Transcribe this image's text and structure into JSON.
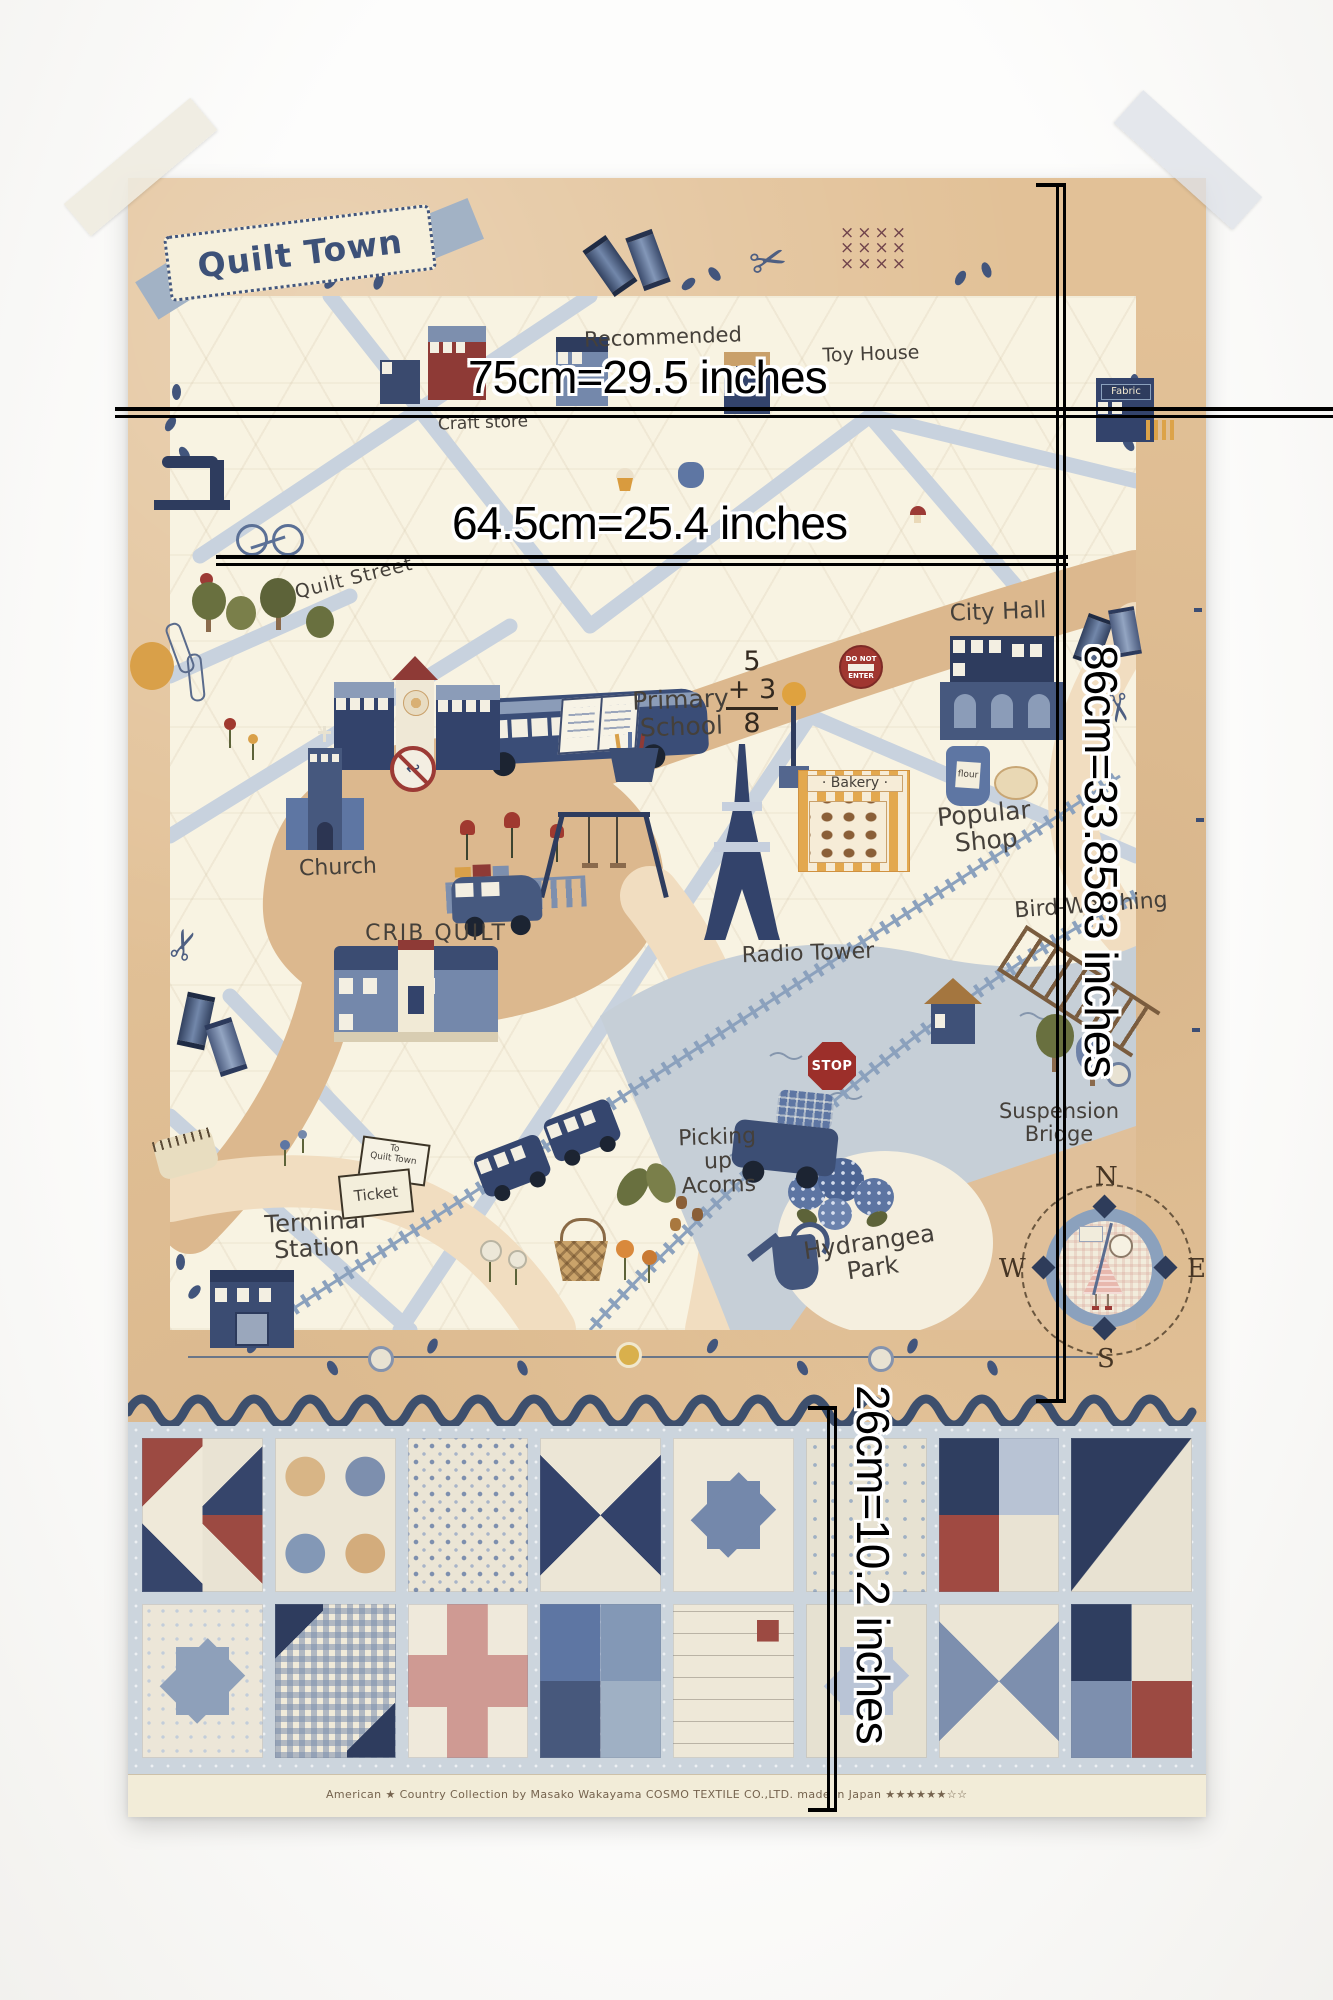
{
  "measurements": {
    "width_top": "75cm=29.5 inches",
    "width_mid": "64.5cm=25.4 inches",
    "height_map": "86cm=33.8583 inches",
    "height_quilt_strip": "26cm=10.2 inches"
  },
  "panel": {
    "banner_title": "Quilt Town",
    "labels": {
      "recommended": "Recommended",
      "toy_house": "Toy House",
      "craft_store": "Craft store",
      "quilt_street": "Quilt Street",
      "city_hall": "City Hall",
      "primary_school": "Primary\nSchool",
      "church": "Church",
      "crib_quilt": "CRIB QUILT",
      "radio_tower": "Radio Tower",
      "bakery": "· Bakery ·",
      "flour": "flour",
      "fabric_shop": "Fabric",
      "popular_shop": "Popular\nShop",
      "bird_watching": "Bird-Watching",
      "suspension_bridge": "Suspension\nBridge",
      "picking_up_acorns": "Picking\nup\nAcorns",
      "hydrangea_park": "Hydrangea\nPark",
      "terminal_station": "Terminal\nStation",
      "ticket": "Ticket",
      "ticket_note": "To\nQuilt Town"
    },
    "signs": {
      "stop": "STOP",
      "do_not_enter_top": "DO NOT",
      "do_not_enter_bottom": "ENTER"
    },
    "math_problem": {
      "addend_top": "5",
      "addend_bottom": "+ 3",
      "sum": "8"
    },
    "compass": {
      "north": "N",
      "east": "E",
      "south": "S",
      "west": "W"
    },
    "selvage": "American ★ Country Collection   by Masako Wakayama    COSMO TEXTILE CO.,LTD.   made in Japan   ★★★★★★☆☆"
  },
  "icons": {
    "scissors": "✂",
    "cross_stitch": "××××\n××××\n××××",
    "no_u_turn_arrow": "↩"
  },
  "colors": {
    "wall": "#fbfbf9",
    "border_tan": "#e2c197",
    "map_cream": "#f8f3e2",
    "road_blue": "#c8d2de",
    "road_tan": "#dcb88e",
    "road_peach": "#f1ddc0",
    "pond": "#c6cfd7",
    "navy": "#33436b",
    "mid_blue": "#7488ab",
    "red": "#9c3a35",
    "orange": "#d9a049",
    "quilt_bg": "#ccd5dd",
    "ricrac": "#3d4f6d",
    "selvage": "#f2ecd8",
    "measure": "#000000",
    "ink": "#45403a"
  }
}
